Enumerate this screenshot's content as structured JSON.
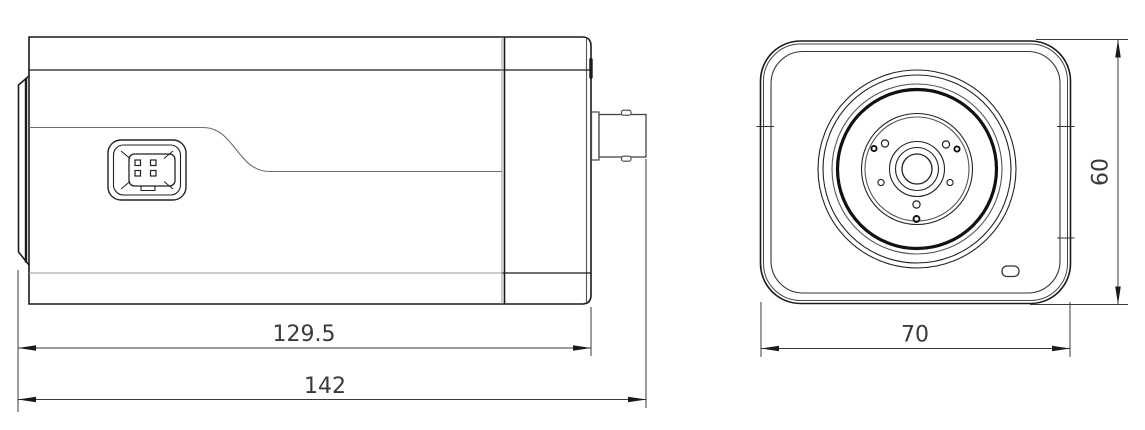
{
  "page": {
    "title": "Box camera dimension drawing",
    "background": "#ffffff"
  },
  "views": {
    "side": {
      "name": "side view"
    },
    "front": {
      "name": "front view"
    }
  },
  "dimensions": {
    "body_length": {
      "label": "129.5",
      "orientation": "horizontal",
      "view": "side"
    },
    "total_length": {
      "label": "142",
      "orientation": "horizontal",
      "view": "side"
    },
    "front_width": {
      "label": "70",
      "orientation": "horizontal",
      "view": "front"
    },
    "front_height": {
      "label": "60",
      "orientation": "vertical",
      "view": "front"
    }
  },
  "colors": {
    "line_dark": "#1a1a1a",
    "line_gray": "#8f8f8f",
    "dimension_text": "#3a3a3a",
    "background": "#ffffff"
  }
}
